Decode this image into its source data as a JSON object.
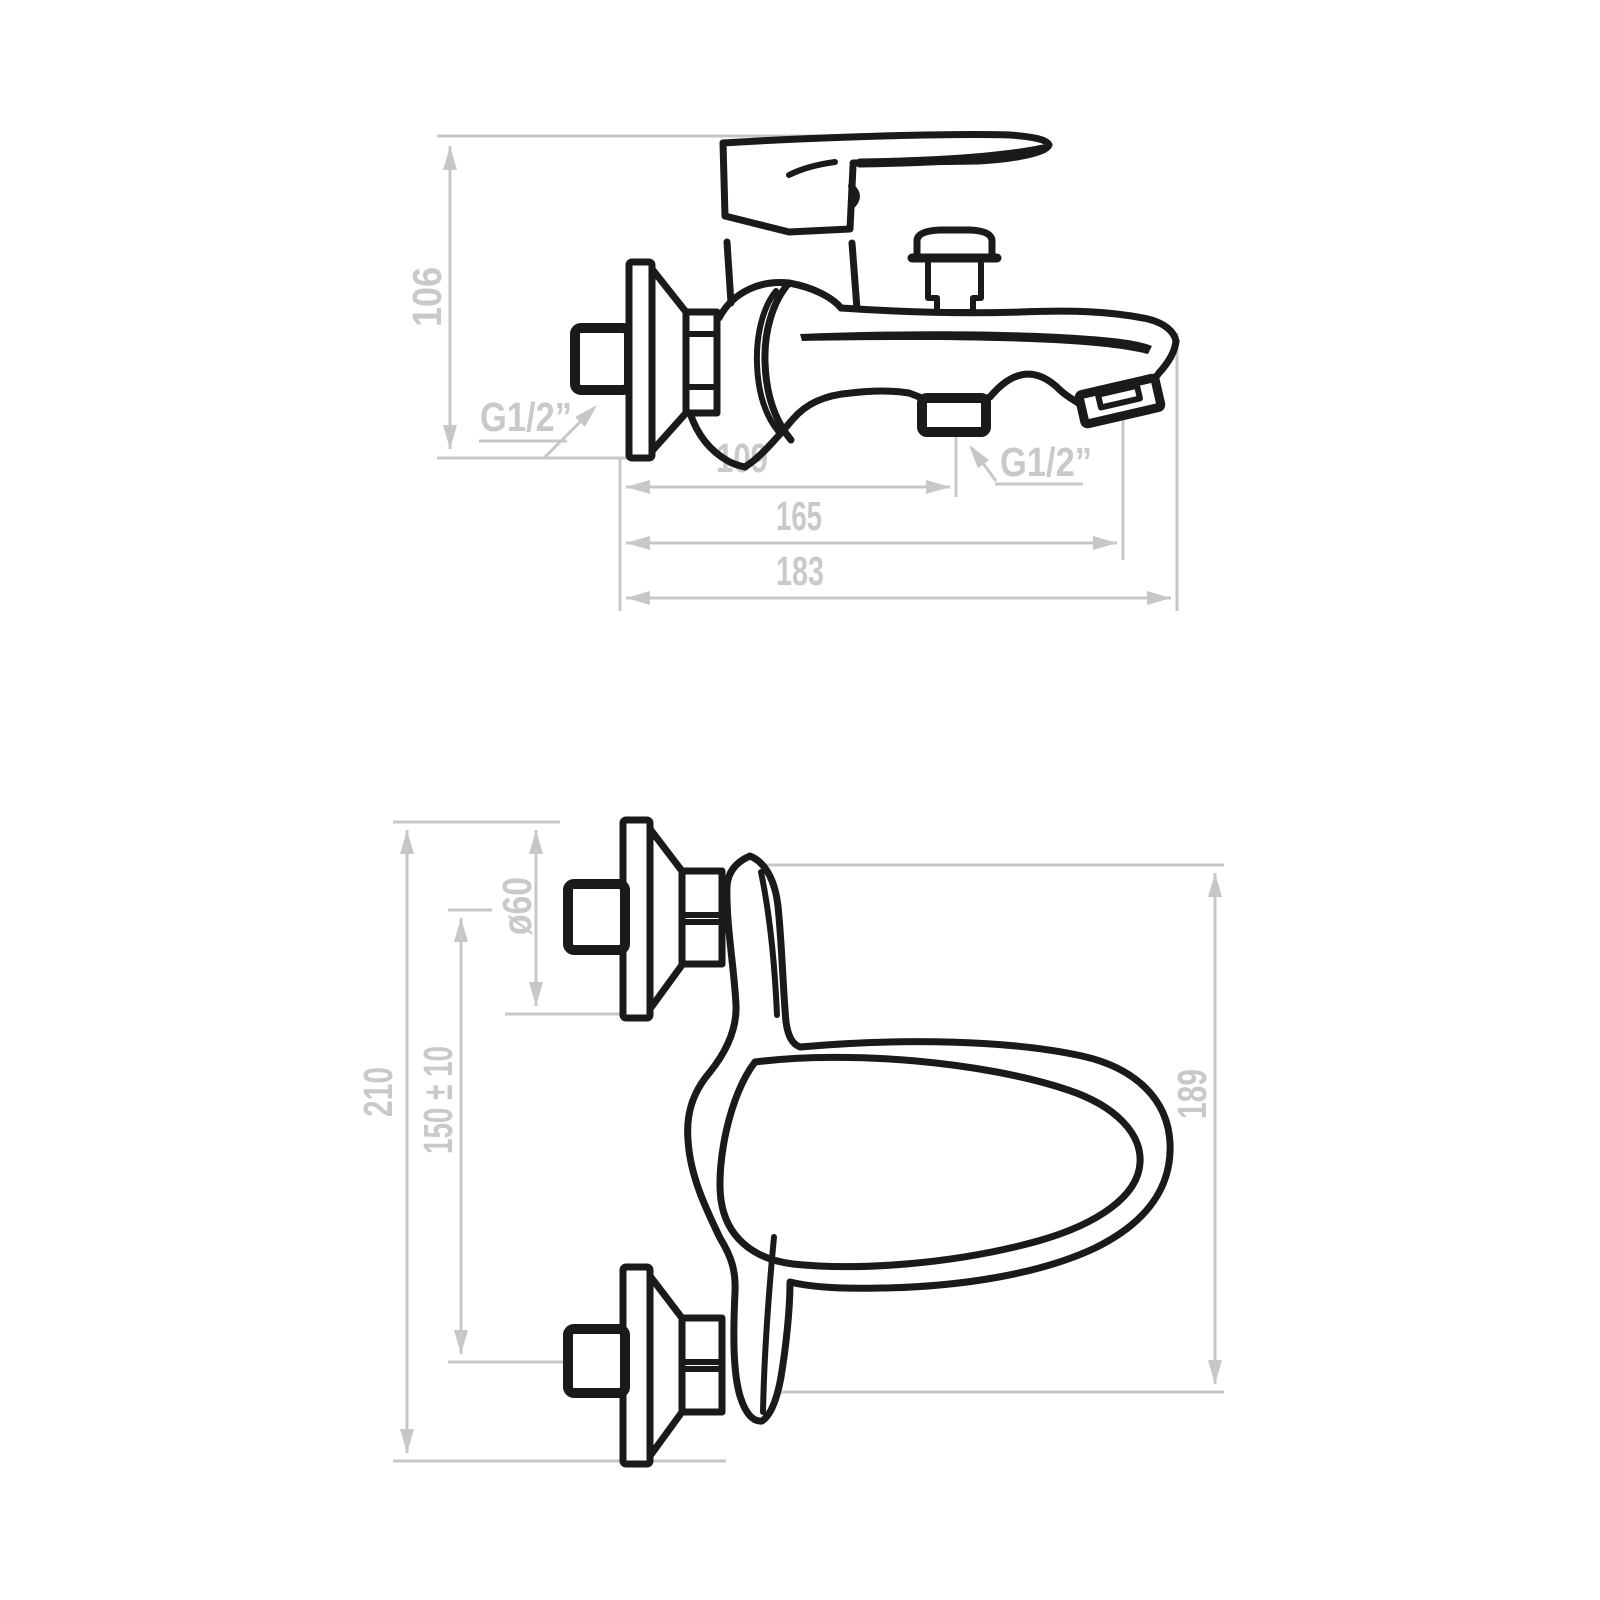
{
  "drawing": {
    "subject": "wall-mounted bath mixer faucet technical drawing, two orthographic views",
    "colors": {
      "line": "#1a1a1a",
      "dimension": "#c7c7c7",
      "background": "#ffffff"
    }
  },
  "side_view": {
    "dims": {
      "height": {
        "label": "106"
      },
      "inlet_thread": {
        "label": "G1/2”"
      },
      "wall_to_diverter": {
        "label": "109"
      },
      "diverter_thread": {
        "label": "G1/2”"
      },
      "wall_to_aerator": {
        "label": "165"
      },
      "total_length": {
        "label": "183"
      }
    }
  },
  "front_view": {
    "dims": {
      "flange_diameter": {
        "label": "ø60"
      },
      "total_height": {
        "label": "210"
      },
      "inlet_spacing": {
        "label": "150 ± 10"
      },
      "body_height": {
        "label": "189"
      }
    }
  }
}
